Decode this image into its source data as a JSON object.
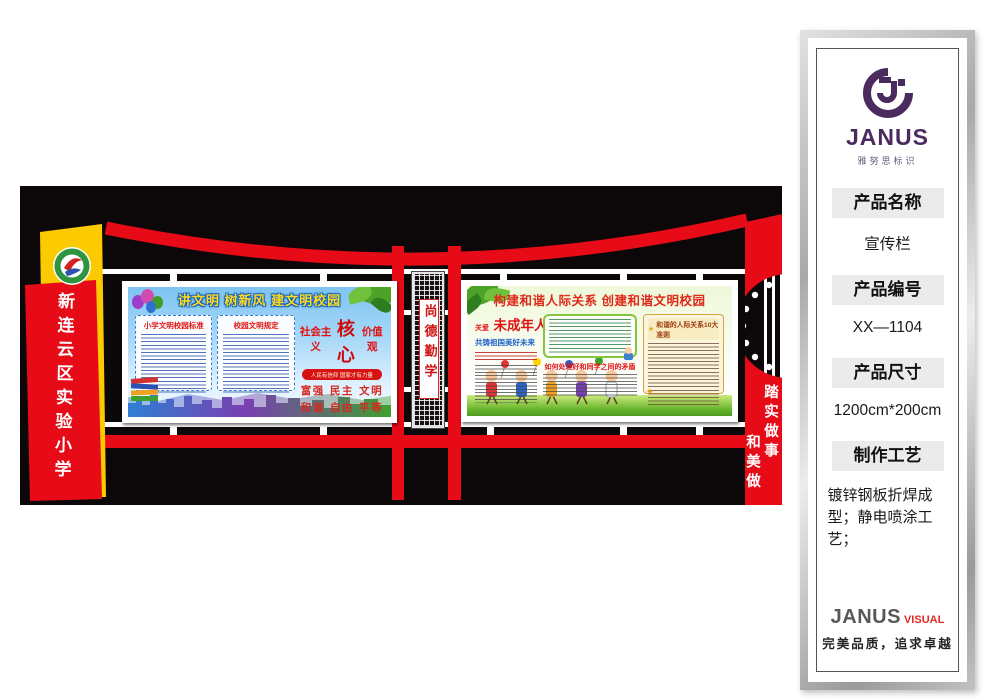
{
  "panel": {
    "brand": {
      "name": "JANUS",
      "tagline": "雅努思标识"
    },
    "fields": [
      {
        "label": "产品名称",
        "value": "宣传栏"
      },
      {
        "label": "产品编号",
        "value": "XX—1104"
      },
      {
        "label": "产品尺寸",
        "value": "1200cm*200cm"
      },
      {
        "label": "制作工艺",
        "value": "镀锌钢板折焊成型；静电喷涂工艺；"
      }
    ],
    "footer": {
      "brand": "JANUS",
      "brand_accent": "VISUAL",
      "slogan": "完美品质，追求卓越"
    }
  },
  "design": {
    "school_banner": "新连云区实验小学",
    "plaque": "尚德勤学",
    "motto_right": {
      "col1": "踏实做事",
      "col2": "和美做"
    },
    "board_left": {
      "title": "讲文明 树新风 建文明校园",
      "panel1_title": "小学文明校园标准",
      "panel2_title": "校园文明规定",
      "values": {
        "prefix": "社会主义",
        "core": "核心",
        "suffix": "价值观",
        "banner": "人民有信仰 国家才有力量",
        "rows": [
          "富强 民主 文明",
          "和谐 自由 平等",
          "公正 法制 爱国",
          "敬业 诚信 友善"
        ]
      }
    },
    "board_right": {
      "title": "构建和谐人际关系 创建和谐文明校园",
      "care_prefix": "关爱",
      "care_title": "未成年人",
      "care_subtitle": "共铸祖国美好未来",
      "mid_heading": "如何处理好和同学之间的矛盾",
      "rules_heading": "和谐的人际关系10大准则",
      "star_glyph": "★"
    },
    "colors": {
      "red": "#e60b17",
      "yellow": "#fcca00",
      "purple": "#4b2b5e"
    }
  }
}
